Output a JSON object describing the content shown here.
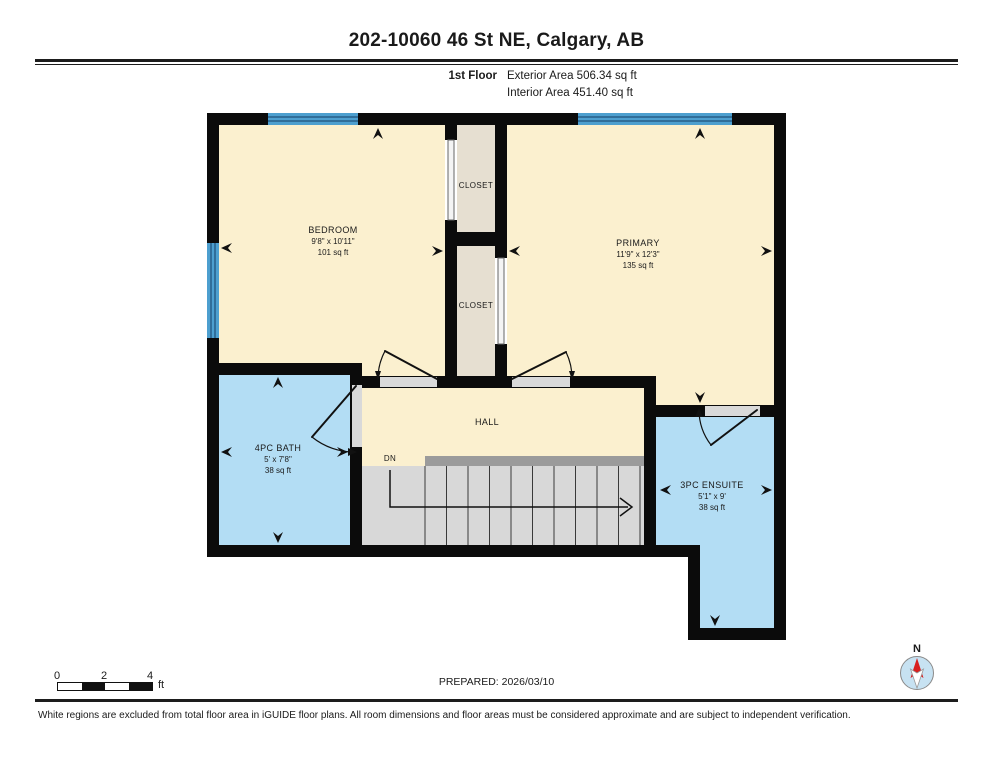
{
  "header": {
    "title": "202-10060 46 St NE, Calgary, AB",
    "floor_label": "1st Floor",
    "exterior_area": "Exterior Area 506.34 sq ft",
    "interior_area": "Interior Area 451.40 sq ft"
  },
  "rooms": {
    "bedroom": {
      "name": "BEDROOM",
      "dims": "9'8\" x 10'11\"",
      "area": "101 sq ft"
    },
    "closet_top": {
      "name": "CLOSET"
    },
    "closet_bottom": {
      "name": "CLOSET"
    },
    "primary": {
      "name": "PRIMARY",
      "dims": "11'9\" x 12'3\"",
      "area": "135 sq ft"
    },
    "bath": {
      "name": "4PC BATH",
      "dims": "5' x 7'8\"",
      "area": "38 sq ft"
    },
    "hall": {
      "name": "HALL"
    },
    "stairs": {
      "label": "DN"
    },
    "ensuite": {
      "name": "3PC ENSUITE",
      "dims": "5'1\" x 9'",
      "area": "38 sq ft"
    }
  },
  "scale_bar": {
    "ticks": [
      "0",
      "2",
      "4"
    ],
    "unit": "ft"
  },
  "footer": {
    "prepared": "PREPARED: 2026/03/10",
    "compass_label": "N",
    "disclaimer": "White regions are excluded from total floor area in iGUIDE floor plans. All room dimensions and floor areas must be considered approximate and are subject to independent verification."
  },
  "palette": {
    "wall": "#0b0b0b",
    "room_cream": "#FBF0CF",
    "closet_tan": "#E6DFD1",
    "wet_room_blue": "#B3DDF4",
    "window_blue": "#4D9FCF",
    "window_stripe": "#275E88",
    "stair_gray": "#D8D8D8",
    "rail_gray": "#9B9B9B",
    "threshold_gray": "#D9D9D9",
    "compass_fill": "#C7E2F2",
    "compass_needle": "#D81F1F"
  }
}
